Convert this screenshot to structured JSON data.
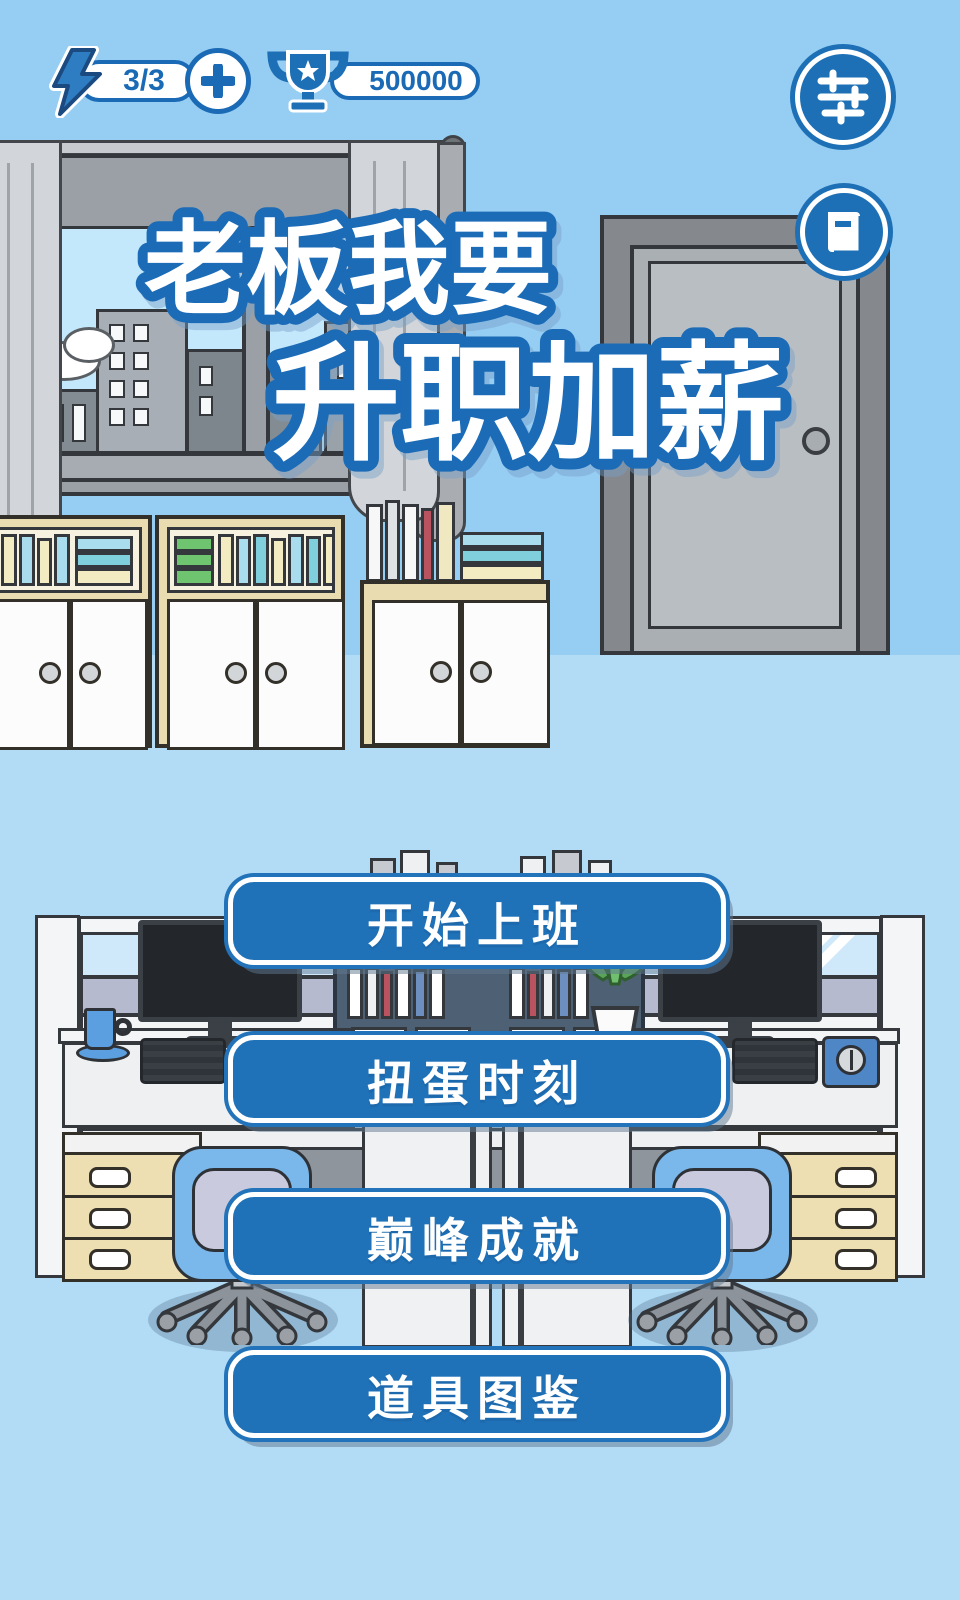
{
  "hud": {
    "energy": {
      "icon": "lightning-icon",
      "value": "3/3",
      "add_label": "+"
    },
    "trophy": {
      "icon": "trophy-icon",
      "value": "500000"
    },
    "settings": {
      "icon": "sliders-icon"
    },
    "guide": {
      "icon": "book-icon"
    }
  },
  "title": {
    "line1": "老板我要",
    "line2": "升职加薪"
  },
  "menu": {
    "buttons": [
      {
        "label": "开始上班"
      },
      {
        "label": "扭蛋时刻"
      },
      {
        "label": "巅峰成就"
      },
      {
        "label": "道具图鉴"
      }
    ]
  },
  "colors": {
    "accent_blue": "#1f72b8",
    "hud_blue": "#1a6ab5",
    "wall": "#96cdf2",
    "floor": "#b2dbf5",
    "button_text": "#ffffff"
  }
}
